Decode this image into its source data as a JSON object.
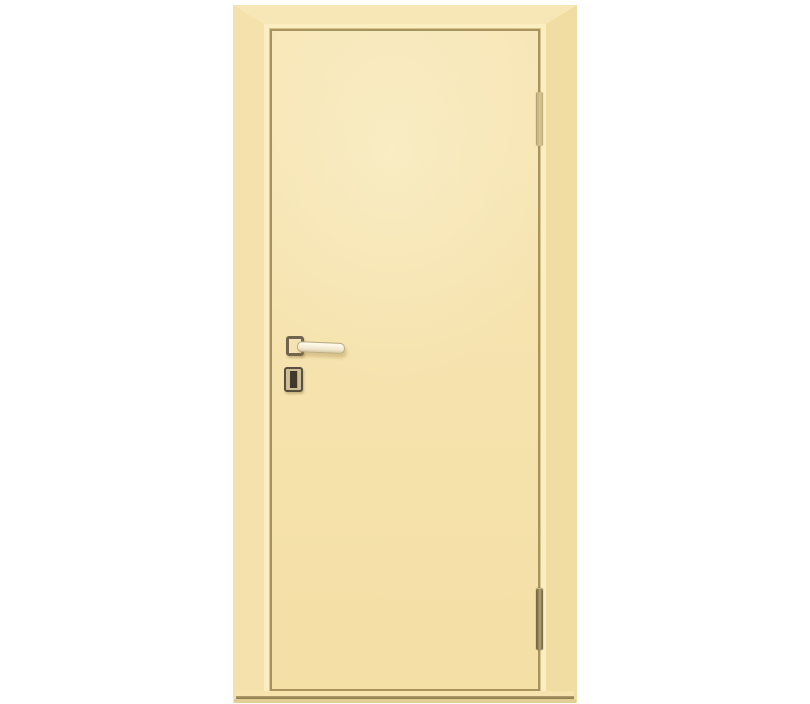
{
  "meta": {
    "description": "Product render of a closed single flush interior door in a cream / ivory painted finish, shown with matching frame casing, lever handle with square rosette, square keyhole escutcheon, two hinges on the right side and a threshold bar, on a plain white background",
    "door_style": "smooth flush leaf, no glazing, no text or labels visible",
    "hinge_side": "right",
    "handle_side": "left"
  },
  "colors": {
    "page_bg": "#ffffff",
    "frame": "#f6e3ae",
    "frame_top": "#f8e7b6",
    "frame_left": "#f5e1ab",
    "frame_right": "#f1dca1",
    "step_light": "#fbeec3",
    "step_shadow": "#d9c489",
    "contour": "#a8925e",
    "leaf_top": "#f7e6b6",
    "leaf_bottom": "#f4dfa5",
    "lever": "#fdf8ea",
    "lever_edge": "#b9ab83",
    "rosette": "#6f6450",
    "escutcheon_frame": "#57503f",
    "escutcheon_plate": "#cdbe96",
    "keyhole": "#3f382b",
    "hinge_light": "#e9dcab",
    "hinge_dark": "#8d7c52",
    "threshold_line": "#8d7950",
    "threshold_base": "#e3cf96"
  },
  "scene": {
    "subject": "cream painted interior door with frame",
    "components": [
      "door-frame-casing",
      "frame-inner-step",
      "door-leaf",
      "lever-handle",
      "handle-rosette",
      "keyhole-escutcheon",
      "top-hinge",
      "bottom-hinge",
      "threshold"
    ]
  }
}
